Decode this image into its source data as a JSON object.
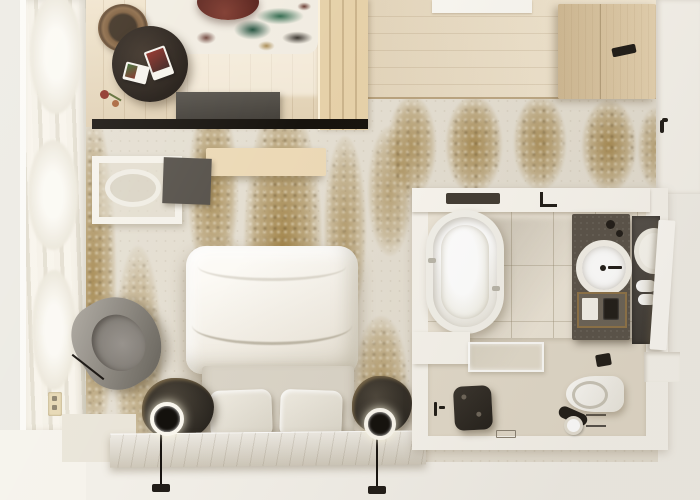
{
  "meta": {
    "title": "Top-down 3D render of a hotel guest room with lounge corner, bedroom and bathroom"
  },
  "palette": {
    "background": "#f2efe8",
    "wall_white": "#f6f3ec",
    "lounge_wood_floor": "#e9d8ba",
    "entry_wood_floor": "#eedfc4",
    "carpet_base": "#e4ded1",
    "carpet_gold": "#947135",
    "partition_wood": "#e6d1a9",
    "wardrobe_wood": "#dcc49c",
    "dark_furniture": "#2a2620",
    "stone_vanity": "#5a5349",
    "marble_bench": "#d9d2c3",
    "armchair_gray": "#8f8b84",
    "burgundy_chair": "#6b2c22",
    "rug_teal": "#1b4a38",
    "bedding_white": "#fcfaf5"
  },
  "rooms": {
    "lounge": {
      "name": "Lounge corner",
      "items": [
        "abstract splash rug",
        "burgundy lounge chair",
        "round black coffee table",
        "magazines",
        "bronze nesting table",
        "flower posy",
        "gray media bench",
        "dark TV wall panel"
      ]
    },
    "entry": {
      "name": "Entry hall",
      "items": [
        "oak plank flooring",
        "slatted wood partition",
        "wardrobe cabinet with recessed handle",
        "white entry mat",
        "door handle"
      ]
    },
    "bedroom": {
      "name": "Bedroom",
      "items": [
        "gold speckled carpet",
        "double bed with white duvet",
        "upholstered base with two cushions",
        "sculptural dark nightstands",
        "glowing ring reading lamps on stems",
        "travertine bench ledge",
        "gray swivel armchair",
        "white desk with oval chair",
        "dark desk mat",
        "floating wood shelf",
        "sheer window curtains",
        "wall outlet"
      ]
    },
    "bathroom": {
      "name": "Bathroom",
      "items": [
        "oval freestanding bathtub",
        "wall tub filler",
        "tiled walls",
        "glass shower bench",
        "dark shower stool",
        "linear floor drain",
        "wall-hung toilet",
        "toilet paper roll",
        "toilet brush",
        "flush plate",
        "stone vanity with round basin",
        "amenity tray",
        "dark mirror cabinet",
        "rolled white towels",
        "open white cabinet door"
      ]
    }
  }
}
